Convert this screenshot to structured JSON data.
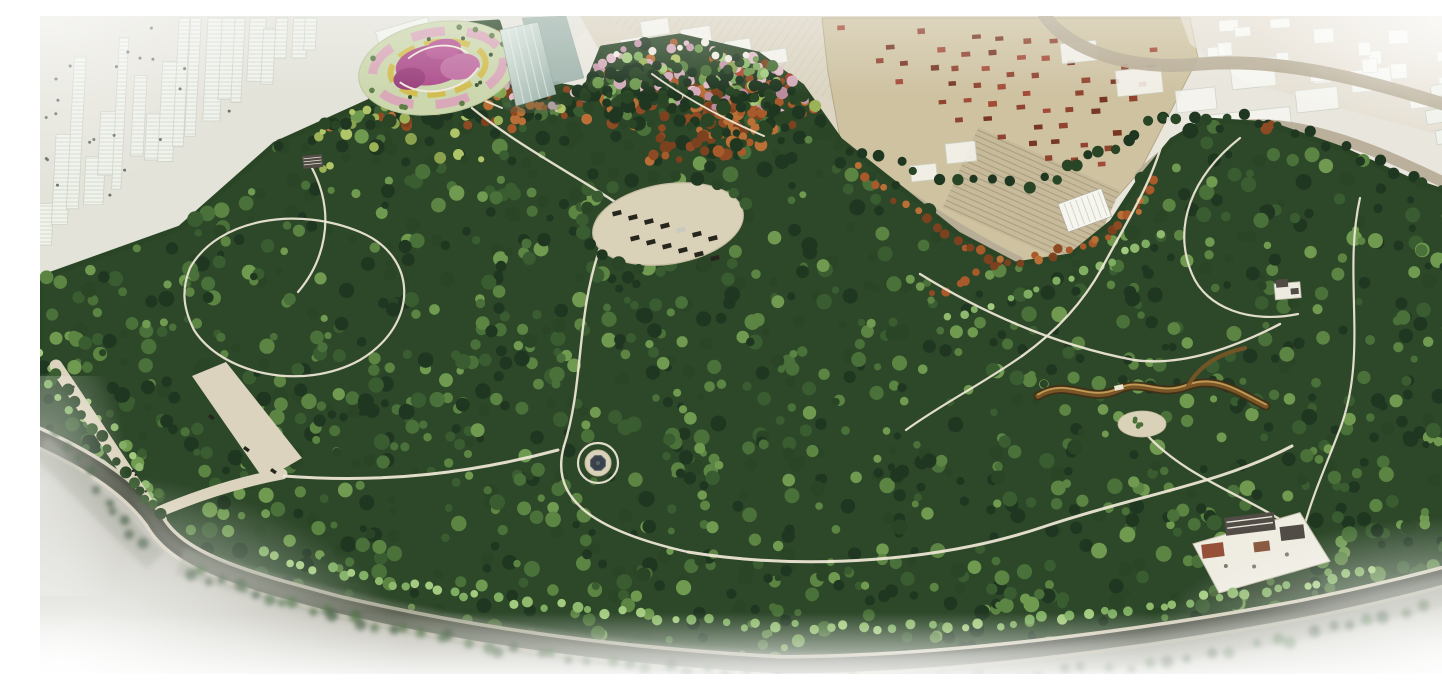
{
  "meta": {
    "title": "Urban Park Masterplan — Aerial Rendering",
    "alt": "Bird's-eye architectural rendering of a large landscaped park surrounded by a ghosted city: high-rise skyline at top-left, an industrial warehouse district with red-roofed units at top-right, a flower parterre garden and glass tower at the north entrance, an oval parking plaza, winding white paths, a central round pavilion, a meandering stream, a traditional courtyard complex at the south-east edge, and perimeter roads fading into white haze at the corners."
  },
  "palette": {
    "page_bg": "#ffffff",
    "haze_bg": "#e9e6dd",
    "city_ground_left": "#e4e3da",
    "city_ground_top": "#dcd5c3",
    "city_ground_right": "#d8cfbb",
    "city_block_fill": "#f0f2ec",
    "city_block_line": "#ccd2c6",
    "city_window_dot": "#4e554b",
    "hatch_line": "#c9c0ac",
    "warehouse_roof": "#cec2a0",
    "warehouse_edge": "#b3a783",
    "shed_roof": "#c6ba9b",
    "shed_ridge": "#a99d7e",
    "warehouse_unit_a": "#8c3c28",
    "warehouse_unit_b": "#a14531",
    "warehouse_unit_c": "#722f1c",
    "shed_fill": "#f6f6f1",
    "road_tan": "#b6ab95",
    "road_dark": "#454a3d",
    "road_mid": "#5a5f50",
    "road_curb": "#d3ccb8",
    "below_road": "#b9b8ad",
    "blur_band": "#7f8574",
    "park_base": "#2d4729",
    "canopy": [
      "#1f3620",
      "#2a4526",
      "#3a5c31",
      "#4a7139",
      "#5c8544",
      "#6f9a50"
    ],
    "light_green": [
      "#8fba6e",
      "#a3cb7f",
      "#7fae63"
    ],
    "yellow_green": [
      "#9cb257",
      "#b0c468",
      "#8aa24e"
    ],
    "autumn": [
      "#8e4a22",
      "#a85a2b",
      "#b96f35",
      "#7c421f"
    ],
    "red": [
      "#a03a24",
      "#b04830"
    ],
    "pink": [
      "#c498ab",
      "#d3aab9",
      "#ba8a9d",
      "#e1bdc8"
    ],
    "white_bloom": [
      "#eae7dd",
      "#f0ece2"
    ],
    "path": "#ece6d4",
    "promenade": "#dbd3bd",
    "plaza": "#d9d1b8",
    "plaza_edge": "#c4bba0",
    "car_dark": "#26261f",
    "car_light": "#c9c9c0",
    "stream_dark": "#3f2f16",
    "stream_mid": "#7a5526",
    "stream_light": "#c9a45e",
    "glass_light": "#dfe9e2",
    "glass_dark": "#9db3ab",
    "glass_edge": "#93a89f",
    "glass_stripe": "#eaf2ec",
    "roof_dark": "#514c46",
    "roof_ridge": "#e9e5d9",
    "pavilion_roof": "#39414a",
    "pavilion_trim": "#5a636c",
    "temple_court": "#efece2",
    "temple_court_edge": "#c6bfae",
    "temple_red": "#96503a",
    "temple_accent": "#8a5a42",
    "structure_wall": "#edeae0",
    "structure_edge": "#b3ada0",
    "greenhouse_ridge": "#d8d4c6",
    "shadow": "#30301f",
    "tower_shadow": "#5a6a55",
    "garden_base": "#ccd7ae",
    "garden_base_edge": "#b9c79a",
    "garden_magenta_a": "#ad4f8c",
    "garden_magenta_b": "#c06fa2",
    "garden_magenta_c": "#993f7c",
    "garden_magenta_d": "#b85a96",
    "garden_pink": "#d9a6bb",
    "garden_yellow": "#d2bd50",
    "garden_speck_green": "#5d7f46",
    "garden_speck_dark": "#3c5531",
    "garden_path": "#efe9da",
    "white": "#ffffff"
  },
  "scene": {
    "regions": [
      {
        "name": "backdrop",
        "label": "hazy city ground plane"
      },
      {
        "name": "city-skyline-top-left",
        "label": "ghosted high-rise skyline"
      },
      {
        "name": "city-blocks-top-center",
        "label": "ghosted city blocks with hatch"
      },
      {
        "name": "industrial-district",
        "label": "warehouse district with red roof units"
      },
      {
        "name": "city-blocks-top-right",
        "label": "hazy low-rise city blocks"
      },
      {
        "name": "city-buildings-right-edge",
        "label": "white slab buildings"
      },
      {
        "name": "approach-roads",
        "label": "boundary approach roads"
      },
      {
        "name": "park-canopy",
        "label": "park tree canopy"
      },
      {
        "name": "grove-clusters",
        "label": "flowering and autumn tree groves"
      },
      {
        "name": "promenade-path",
        "label": "west entrance promenade"
      },
      {
        "name": "walking-paths",
        "label": "winding walking paths"
      },
      {
        "name": "flower-garden",
        "label": "parterre flower garden"
      },
      {
        "name": "glass-tower",
        "label": "glass tower landmark"
      },
      {
        "name": "parking-plaza",
        "label": "oval parking plaza with cars"
      },
      {
        "name": "stream",
        "label": "meandering dry stream"
      },
      {
        "name": "clearing-plaza",
        "label": "sand clearing"
      },
      {
        "name": "garden-structures",
        "label": "pavilions, greenhouse and courtyard complex"
      },
      {
        "name": "perimeter-road",
        "label": "dark perimeter road"
      },
      {
        "name": "roadside-trees",
        "label": "street tree rows"
      },
      {
        "name": "vignette",
        "label": "white corner haze vignette"
      }
    ]
  }
}
